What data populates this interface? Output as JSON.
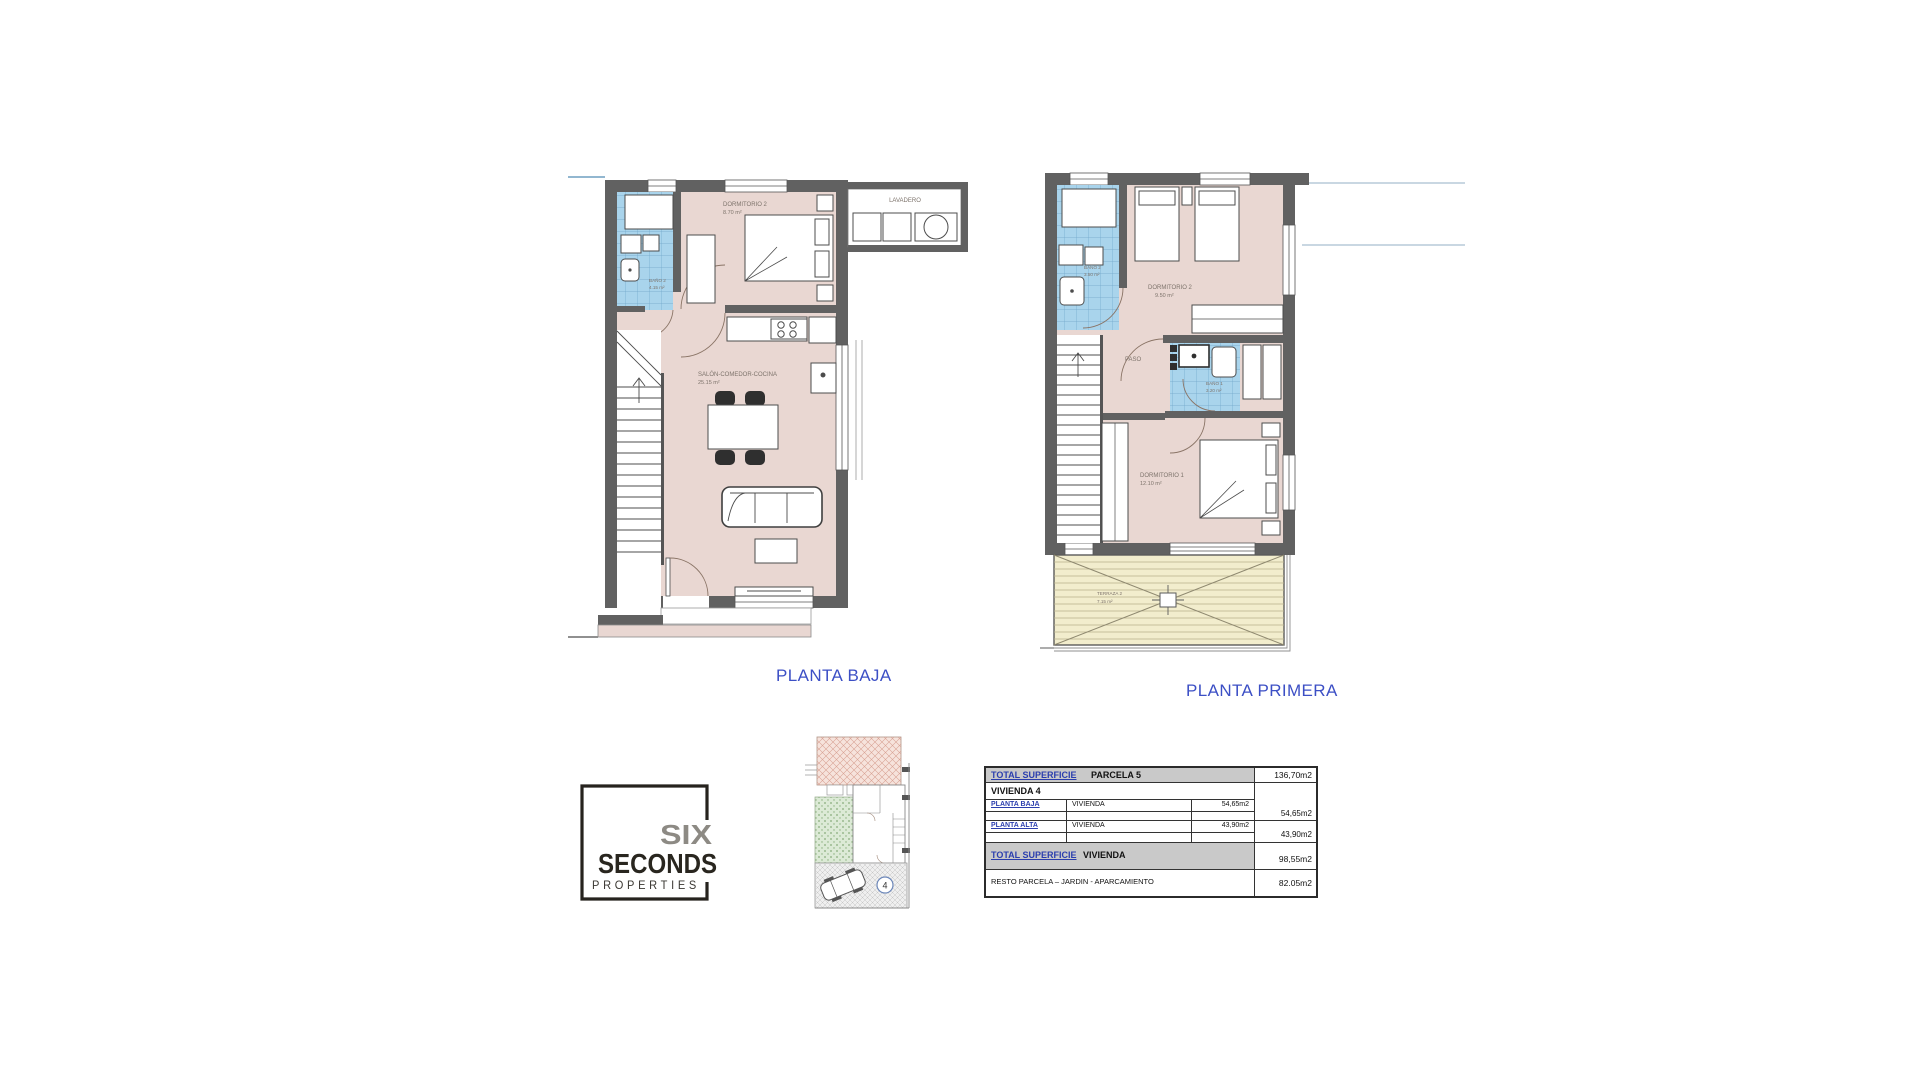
{
  "titles": {
    "ground": "PLANTA BAJA",
    "first": "PLANTA PRIMERA"
  },
  "ground_plan": {
    "lavadero": "LAVADERO",
    "dormitorio2": {
      "name": "DORMITORIO 2",
      "area": "8.70 m²"
    },
    "bano2": {
      "name": "BAÑO 2",
      "area": "4.15 m²"
    },
    "salon": {
      "name": "SALÓN-COMEDOR-COCINA",
      "area": "25.15 m²"
    }
  },
  "first_plan": {
    "bano2": {
      "name": "BAÑO 2",
      "area": "3.50 m²"
    },
    "dormitorio2": {
      "name": "DORMITORIO 2",
      "area": "9.50 m²"
    },
    "paso": "PASO",
    "bano1": {
      "name": "BAÑO 1",
      "area": "3.20 m²"
    },
    "dormitorio1": {
      "name": "DORMITORIO 1",
      "area": "12.10 m²"
    },
    "terraza2": {
      "name": "TERRAZA 2",
      "area": "7.15 m²"
    }
  },
  "logo": {
    "six": "SIX",
    "seconds": "SECONDS",
    "properties": "PROPERTIES"
  },
  "site_plan": {
    "plot_number": "4"
  },
  "table": {
    "header_label": "TOTAL SUPERFICIE",
    "header_name": "PARCELA 5",
    "header_value": "136,70m2",
    "vivienda_label": "VIVIENDA 4",
    "rows": [
      {
        "floor": "PLANTA BAJA",
        "use": "VIVIENDA",
        "value": "54,65m2",
        "total": "54,65m2"
      },
      {
        "floor": "PLANTA ALTA",
        "use": "VIVIENDA",
        "value": "43,90m2",
        "total": "43,90m2"
      }
    ],
    "total_label": "TOTAL SUPERFICIE",
    "total_name": "VIVIENDA",
    "total_value": "98,55m2",
    "resto_label": "RESTO PARCELA – JARDIN - APARCAMIENTO",
    "resto_value": "82.05m2"
  },
  "colors": {
    "accent_blue": "#3c4fc5",
    "table_blue": "#2b3eae",
    "wall_gray": "#616161",
    "room_pink": "#e9d7d2",
    "bath_blue": "#a9d4ec",
    "terrace_cream": "#f2edcd"
  }
}
